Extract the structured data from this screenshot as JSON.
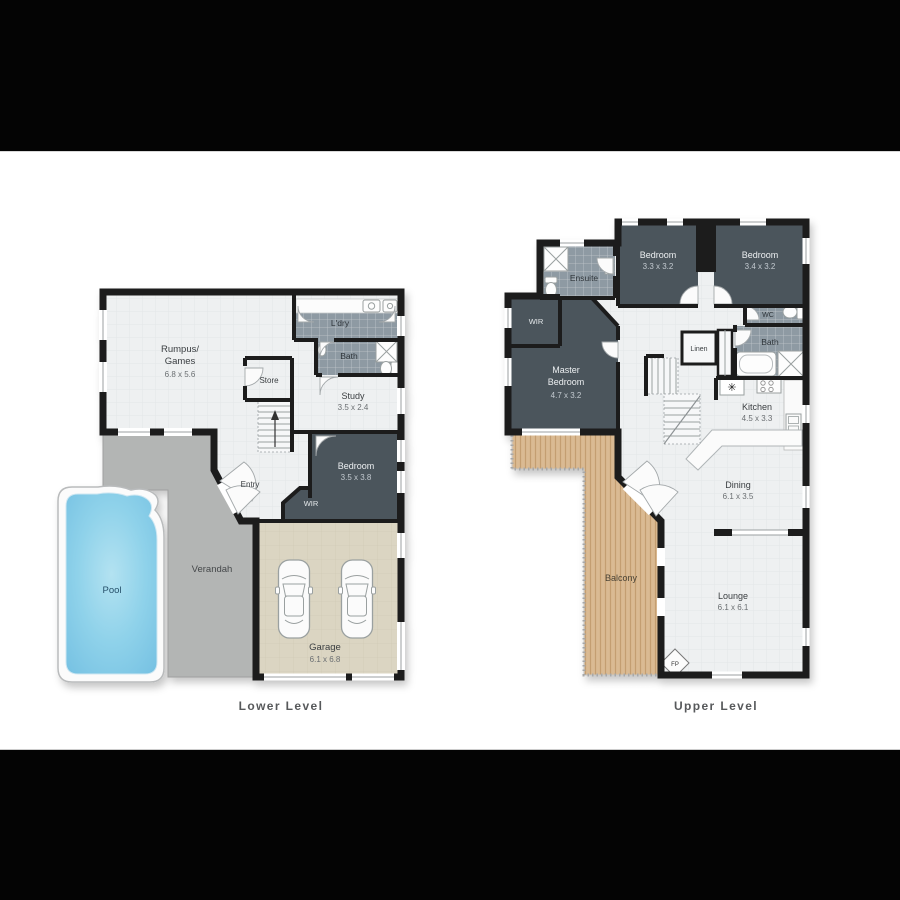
{
  "meta": {
    "lower_title": "Lower Level",
    "upper_title": "Upper Level"
  },
  "palette": {
    "letterbox": "#040404",
    "canvas": "#ffffff",
    "wall": "#1d1d1f",
    "dark_room": "#4b545c",
    "tile_room": "#8e9aa3",
    "light_floor": "#eef0f1",
    "garage_floor": "#dbd5c2",
    "verandah": "#b3b5b4",
    "deck_wood": "#d8b78e",
    "pool_water": "#7ec4e6"
  },
  "lower": {
    "rumpus": {
      "line1": "Rumpus/",
      "line2": "Games",
      "size": "6.8 x 5.6"
    },
    "ldry": {
      "name": "L'dry"
    },
    "bath": {
      "name": "Bath"
    },
    "store": {
      "name": "Store"
    },
    "study": {
      "name": "Study",
      "size": "3.5 x 2.4"
    },
    "bedroom": {
      "name": "Bedroom",
      "size": "3.5 x 3.8"
    },
    "wir": {
      "name": "WIR"
    },
    "entry": {
      "name": "Entry"
    },
    "verandah": {
      "name": "Verandah"
    },
    "garage": {
      "name": "Garage",
      "size": "6.1 x 6.8"
    },
    "pool": {
      "name": "Pool"
    }
  },
  "upper": {
    "ensuite": {
      "name": "Ensuite"
    },
    "bedroom1": {
      "name": "Bedroom",
      "size": "3.3 x 3.2"
    },
    "bedroom2": {
      "name": "Bedroom",
      "size": "3.4 x 3.2"
    },
    "wir": {
      "name": "WIR"
    },
    "master": {
      "line1": "Master",
      "line2": "Bedroom",
      "size": "4.7 x 3.2"
    },
    "linen": {
      "name": "Linen"
    },
    "wc": {
      "name": "WC"
    },
    "bath": {
      "name": "Bath"
    },
    "kitchen": {
      "name": "Kitchen",
      "size": "4.5 x 3.3",
      "pantry_symbol": "✳"
    },
    "dining": {
      "name": "Dining",
      "size": "6.1 x 3.5"
    },
    "lounge": {
      "name": "Lounge",
      "size": "6.1 x 6.1"
    },
    "balcony": {
      "name": "Balcony"
    },
    "fireplace": {
      "abbr": "FP"
    }
  }
}
